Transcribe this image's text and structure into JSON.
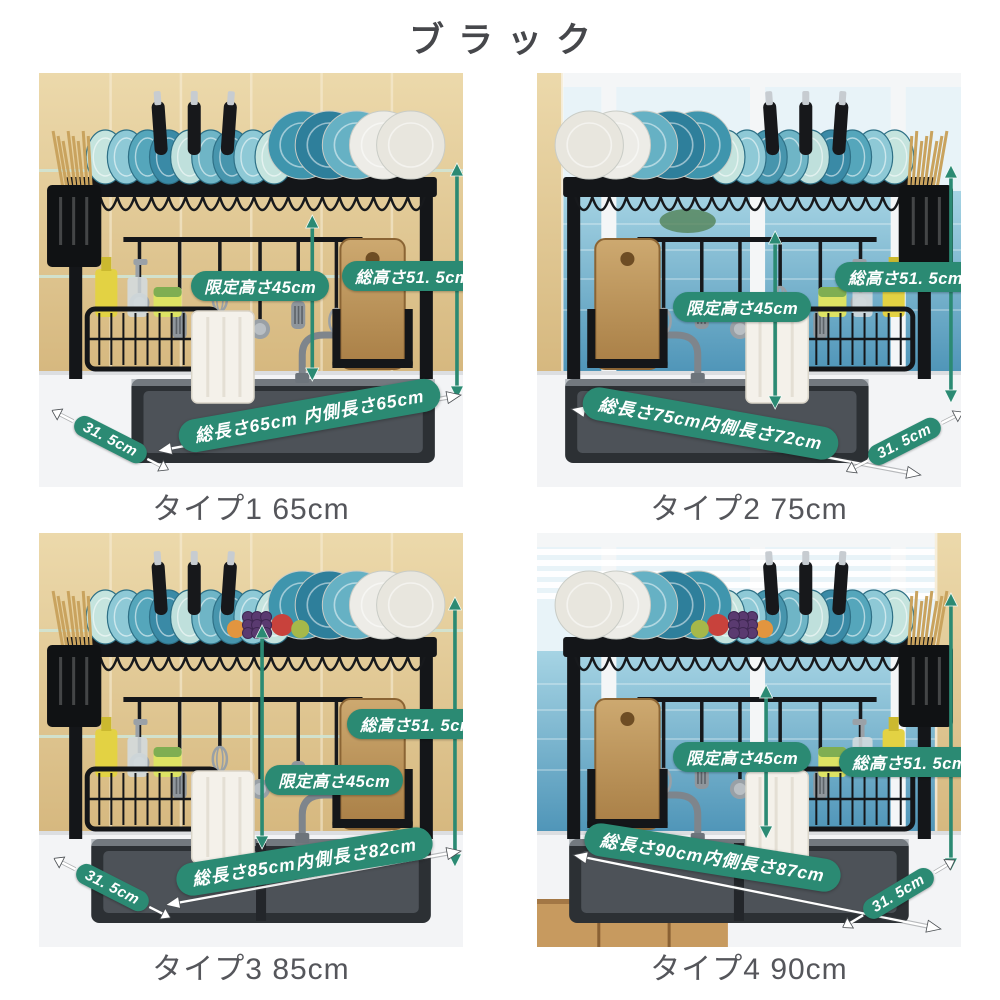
{
  "page": {
    "title": "ブラック"
  },
  "theme": {
    "badge_color": "#2b8a73",
    "arrow_color": "#2b8a73",
    "title_color": "#46474b",
    "caption_color": "#55565b"
  },
  "panels": [
    {
      "caption": "タイプ1 65cm",
      "scene": "black dish drying rack over sink, beige tile wall",
      "labels": {
        "limited_height": "限定高さ45cm",
        "total_height": "総高さ51. 5cm",
        "total_length": "総長さ65cm 内側長さ65cm",
        "depth": "31. 5cm"
      }
    },
    {
      "caption": "タイプ2 75cm",
      "scene": "black dish drying rack over sink, window with sea view",
      "labels": {
        "limited_height": "限定高さ45cm",
        "total_height": "総高さ51. 5cm",
        "total_length": "総長さ75cm内側長さ72cm",
        "depth": "31. 5cm"
      }
    },
    {
      "caption": "タイプ3 85cm",
      "scene": "black dish drying rack over double sink, beige tile wall, fruit on shelf",
      "labels": {
        "limited_height": "限定高さ45cm",
        "total_height": "総高さ51. 5cm",
        "total_length": "総長さ85cm内側長さ82cm",
        "depth": "31. 5cm"
      }
    },
    {
      "caption": "タイプ4 90cm",
      "scene": "black dish drying rack over double sink, window with blinds and sea view, fruit on shelf",
      "labels": {
        "limited_height": "限定高さ45cm",
        "total_height": "総高さ51. 5cm",
        "total_length": "総長さ90cm内側長さ87cm",
        "depth": "31. 5cm"
      }
    }
  ]
}
